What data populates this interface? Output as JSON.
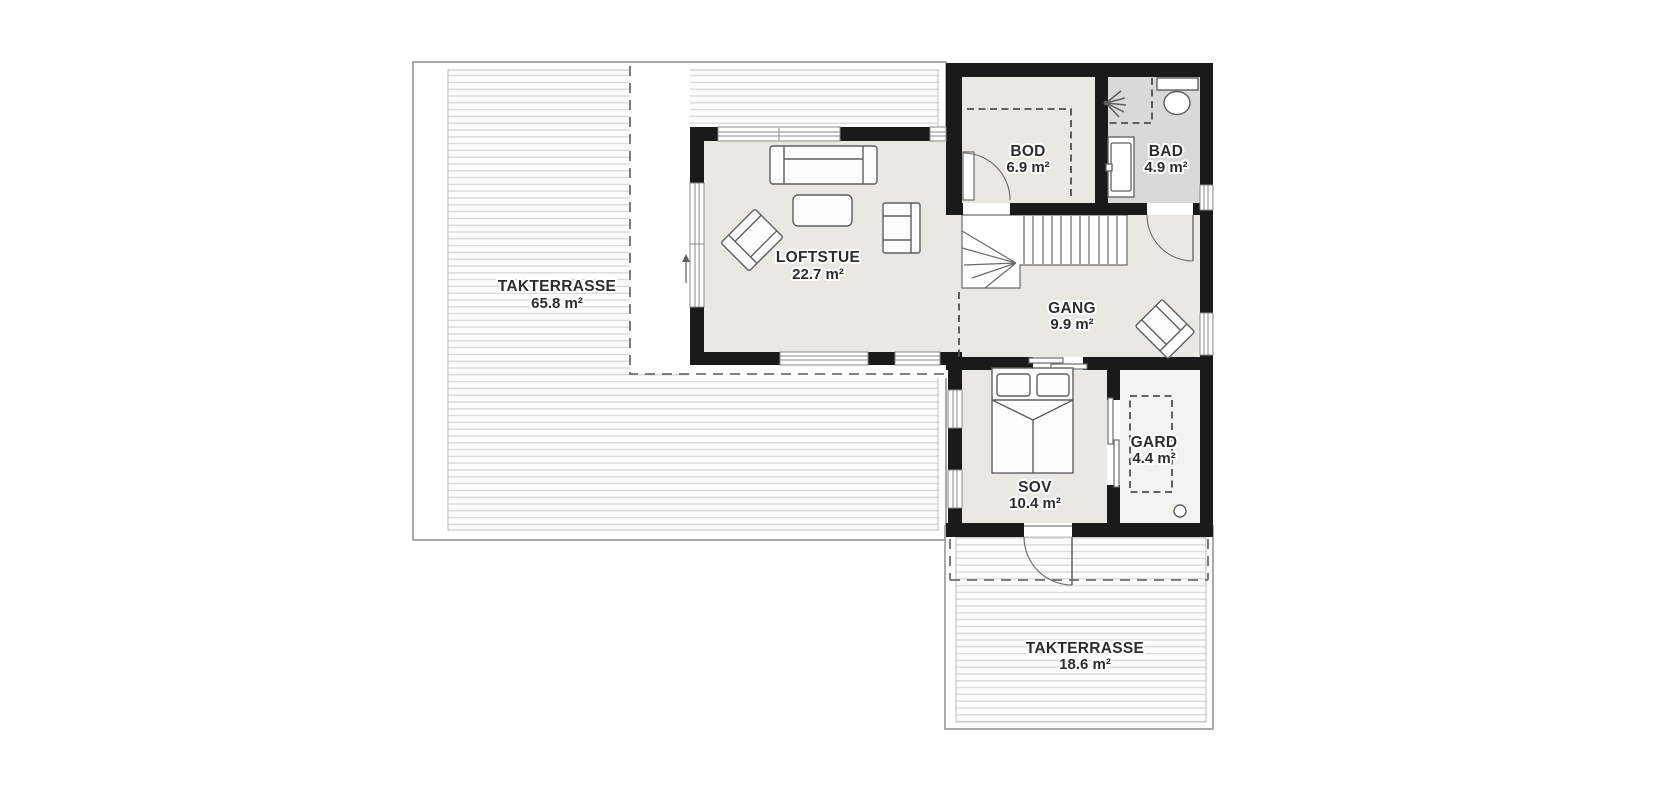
{
  "plan": {
    "rooms": {
      "takterrasse_left": {
        "name": "TAKTERRASSE",
        "area": "65.8 m²"
      },
      "loftstue": {
        "name": "LOFTSTUE",
        "area": "22.7 m²"
      },
      "bod": {
        "name": "BOD",
        "area": "6.9 m²"
      },
      "bad": {
        "name": "BAD",
        "area": "4.9 m²"
      },
      "gang": {
        "name": "GANG",
        "area": "9.9 m²"
      },
      "sov": {
        "name": "SOV",
        "area": "10.4 m²"
      },
      "gard": {
        "name": "GARD",
        "area": "4.4 m²"
      },
      "takterrasse_lower": {
        "name": "TAKTERRASSE",
        "area": "18.6 m²"
      }
    },
    "colors": {
      "wall": "#1a1a18",
      "room_floor": "#e9e8e2",
      "bathroom_floor": "#d9d9d7",
      "closet_floor": "#f3f3f0",
      "deck_line": "#d8d8d6",
      "dash": "#6e6e6e",
      "terrace_border": "#8f8f8f",
      "furniture_stroke": "#5f5f5f",
      "label_text": "#2d2d2b"
    },
    "icons": {
      "toilet": "toilet-icon",
      "shower": "shower-icon",
      "vanity": "sink-vanity-icon",
      "entry_arrow": "entry-arrow-icon"
    }
  }
}
